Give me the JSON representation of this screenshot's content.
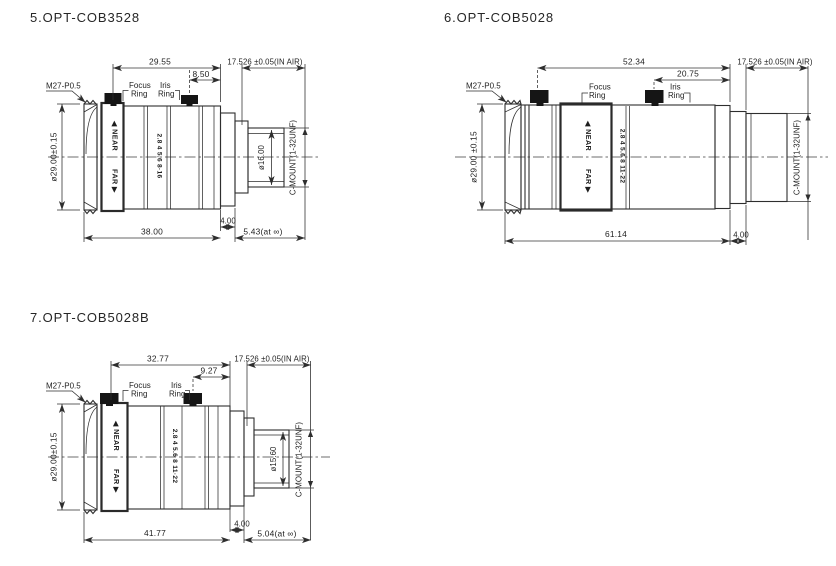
{
  "page": {
    "background": "#ffffff",
    "ink": "#2e2e2e"
  },
  "drawings": [
    {
      "title": "5.OPT-COB3528",
      "thread_label": "M27-P0.5",
      "focus_ring_label": {
        "line1": "Focus",
        "line2": "Ring"
      },
      "iris_ring_label": {
        "line1": "Iris",
        "line2": "Ring"
      },
      "barrel_markings": {
        "near": "◀ NEAR",
        "far": "FAR ▶",
        "aperture_scale": "2.8 4 5.6 8·16"
      },
      "dims": {
        "upper_length": "29.55",
        "iris_offset": "8.50",
        "flange_focal": "17.526 ±0.05(IN AIR)",
        "outer_diameter": "ø29.00±0.15",
        "rear_inner_diameter": "ø16.00",
        "mount": "C-MOUNT(1-32UNF)",
        "body_length": "38.00",
        "rear_flange": "4.00",
        "back_focus": "5.43(at ∞)"
      }
    },
    {
      "title": "6.OPT-COB5028",
      "thread_label": "M27-P0.5",
      "focus_ring_label": {
        "line1": "Focus",
        "line2": "Ring"
      },
      "iris_ring_label": {
        "line1": "Iris",
        "line2": "Ring"
      },
      "barrel_markings": {
        "near": "◀ NEAR",
        "far": "FAR ▶",
        "aperture_scale": "2.8 4 5.6 8 11·22"
      },
      "dims": {
        "upper_length": "52.34",
        "iris_offset": "20.75",
        "flange_focal": "17.526 ±0.05(IN AIR)",
        "outer_diameter": "ø29.00 ±0.15",
        "mount": "C-MOUNT(1-32UNF)",
        "body_length": "61.14",
        "rear_flange": "4.00"
      }
    },
    {
      "title": "7.OPT-COB5028B",
      "thread_label": "M27-P0.5",
      "focus_ring_label": {
        "line1": "Focus",
        "line2": "Ring"
      },
      "iris_ring_label": {
        "line1": "Iris",
        "line2": "Ring"
      },
      "barrel_markings": {
        "near": "◀ NEAR",
        "far": "FAR ▶",
        "aperture_scale": "2.8 4 5.6 8 11·22"
      },
      "dims": {
        "upper_length": "32.77",
        "iris_offset": "9.27",
        "flange_focal": "17.526 ±0.05(IN AIR)",
        "outer_diameter": "ø29.00±0.15",
        "rear_inner_diameter": "ø15.60",
        "mount": "C-MOUNT(1-32UNF)",
        "body_length": "41.77",
        "rear_flange": "4.00",
        "back_focus": "5.04(at ∞)"
      }
    }
  ]
}
